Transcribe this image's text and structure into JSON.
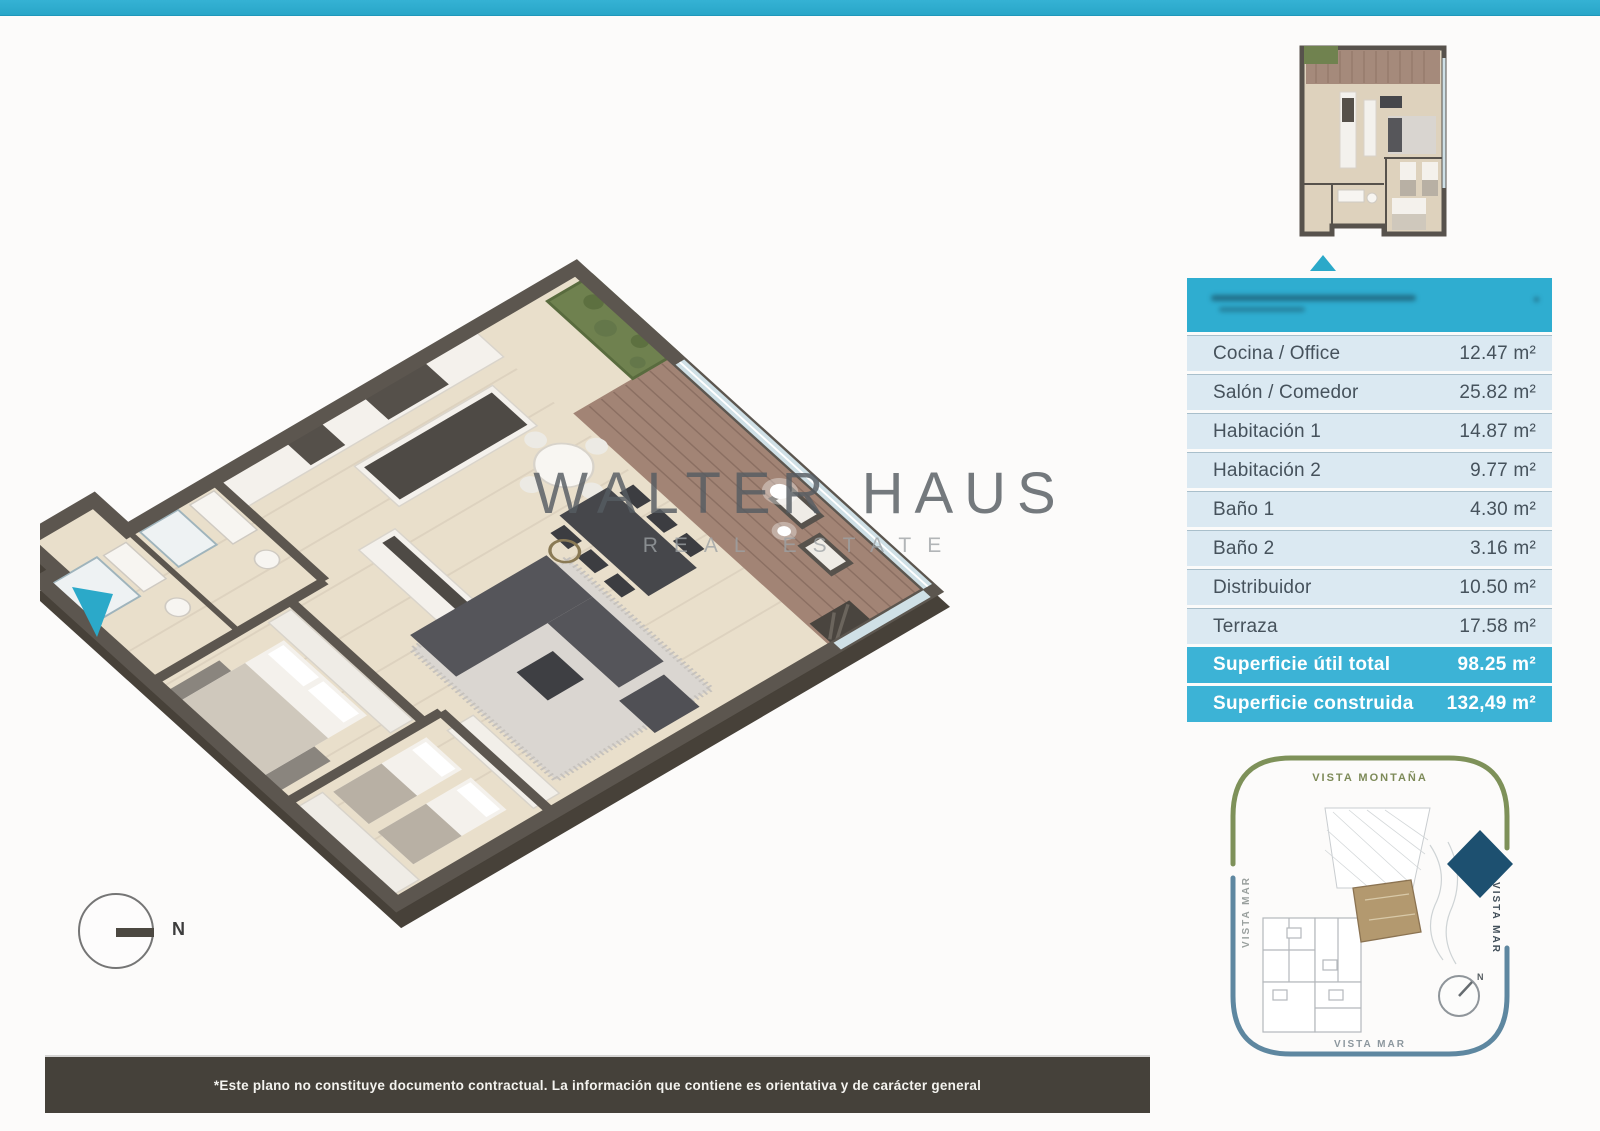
{
  "colors": {
    "accent": "#2ba9c9",
    "table_header": "#2fadd0",
    "table_row_bg": "#dbe9f2",
    "table_total_bg": "#3cb3d6",
    "footer_bg": "#45413a",
    "terrace_deck": "#a28475",
    "hedge_green": "#6f814f",
    "site_green_arc": "#7e9159",
    "site_blue_arc": "#5e87a0",
    "site_navy_marker": "#1d5070",
    "site_unit_tan": "#b3996f"
  },
  "watermark": {
    "title": "WALTER HAUS",
    "subtitle": "REAL ESTATE"
  },
  "compass": {
    "label": "N"
  },
  "area_table": {
    "rows": [
      {
        "label": "Cocina / Office",
        "value": "12.47 m²"
      },
      {
        "label": "Salón / Comedor",
        "value": "25.82 m²"
      },
      {
        "label": "Habitación 1",
        "value": "14.87 m²"
      },
      {
        "label": "Habitación 2",
        "value": "9.77 m²"
      },
      {
        "label": "Baño 1",
        "value": "4.30 m²"
      },
      {
        "label": "Baño 2",
        "value": "3.16 m²"
      },
      {
        "label": "Distribuidor",
        "value": "10.50 m²"
      },
      {
        "label": "Terraza",
        "value": "17.58 m²"
      }
    ],
    "totals": [
      {
        "label": "Superficie útil total",
        "value": "98.25 m²"
      },
      {
        "label": "Superficie construida",
        "value": "132,49 m²"
      }
    ]
  },
  "site_plan": {
    "top_label": "VISTA MONTAÑA",
    "left_label": "VISTA MAR",
    "right_label": "VISTA MAR",
    "bottom_label": "VISTA MAR",
    "compass_label": "N"
  },
  "footer": {
    "disclaimer": "*Este plano no constituye documento contractual. La información que contiene es orientativa y de carácter general"
  }
}
